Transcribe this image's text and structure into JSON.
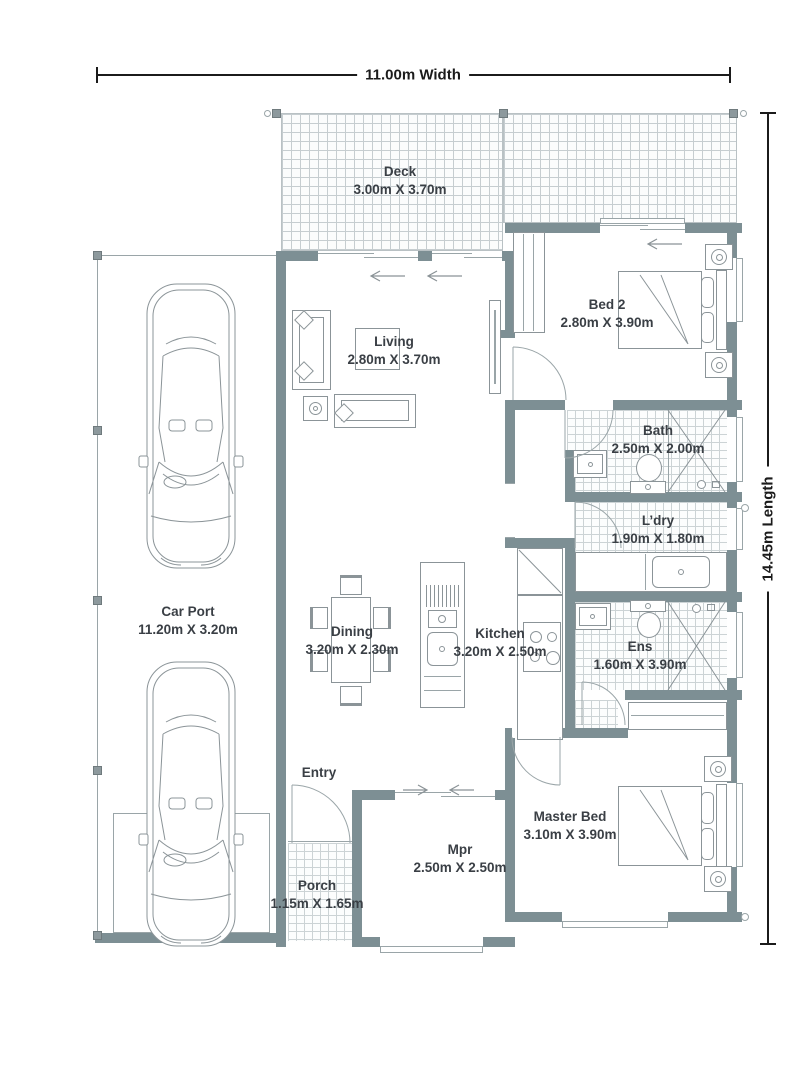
{
  "dimensions": {
    "width_label": "11.00m Width",
    "length_label": "14.45m Length"
  },
  "rooms": {
    "deck": {
      "name": "Deck",
      "size": "3.00m X 3.70m"
    },
    "bed2": {
      "name": "Bed 2",
      "size": "2.80m X 3.90m"
    },
    "living": {
      "name": "Living",
      "size": "2.80m X 3.70m"
    },
    "bath": {
      "name": "Bath",
      "size": "2.50m X 2.00m"
    },
    "ldry": {
      "name": "L’dry",
      "size": "1.90m X 1.80m"
    },
    "carport": {
      "name": "Car Port",
      "size": "11.20m X 3.20m"
    },
    "dining": {
      "name": "Dining",
      "size": "3.20m X 2.30m"
    },
    "kitchen": {
      "name": "Kitchen",
      "size": "3.20m X 2.50m"
    },
    "ens": {
      "name": "Ens",
      "size": "1.60m X 3.90m"
    },
    "master": {
      "name": "Master Bed",
      "size": "3.10m X 3.90m"
    },
    "entry": {
      "name": "Entry"
    },
    "mpr": {
      "name": "Mpr",
      "size": "2.50m X 2.50m"
    },
    "porch": {
      "name": "Porch",
      "size": "1.15m X 1.65m"
    }
  },
  "colors": {
    "wall": "#7d8f94",
    "line": "#9aa5a8",
    "furniture": "#8b9498",
    "tile": "#ccd3d5",
    "deck_grid": "#c6cdd0",
    "text": "#3a3f45",
    "dimension": "#1b1b1b"
  }
}
